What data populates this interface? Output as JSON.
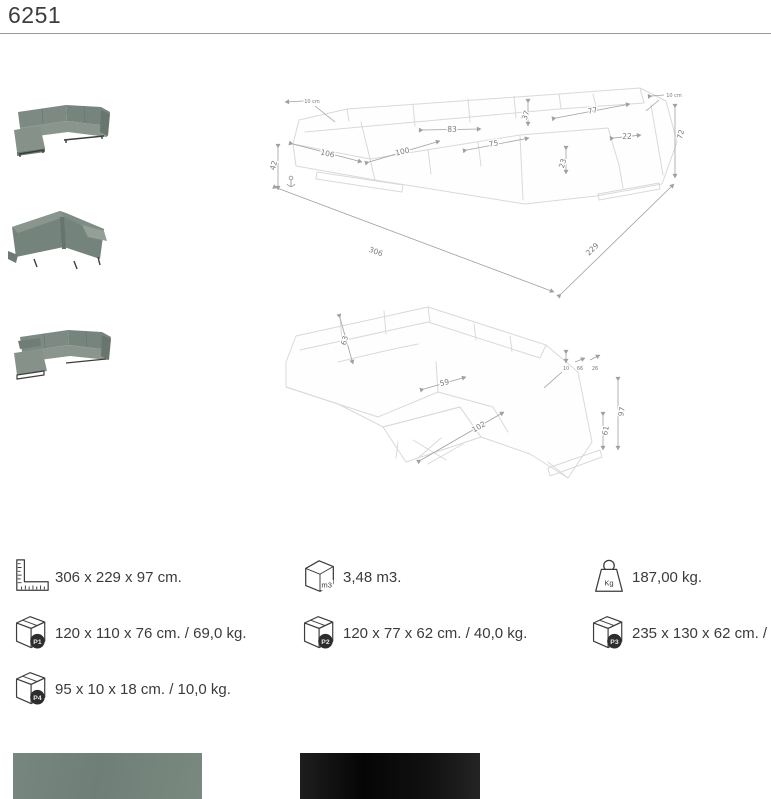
{
  "title": "6251",
  "colors": {
    "sofa_fabric": "#7b8a84",
    "swatch_green_grey": "#75847d",
    "swatch_black": "#121212",
    "line_art": "#d9d9d9",
    "dimension_grey": "#7a7a7a"
  },
  "drawing_top": {
    "dims": {
      "headrest_left": "10 cm",
      "corner_back_width": "83",
      "back_cushion_height": "37",
      "right_back_width": "77",
      "arm_width": "22",
      "height_total": "72",
      "headrest_right": "10 cm",
      "chaise_front": "106",
      "seat_front": "100",
      "right_seat_front": "75",
      "seat_front_height": "23",
      "seat_height": "42",
      "length_total": "306",
      "depth_total": "229"
    }
  },
  "drawing_bottom": {
    "dims": {
      "back_cushion": "63",
      "corner_seat": "59",
      "recline_depth": "102",
      "footrest_height": "61",
      "height_headrest_up": "97",
      "inset_a": "10",
      "inset_b": "66",
      "inset_c": "26"
    }
  },
  "specs": {
    "dimensions": {
      "icon": "ruler-square-icon",
      "text": "306 x 229 x 97 cm."
    },
    "volume": {
      "icon": "cube-m3-icon",
      "icon_label": "m3",
      "text": "3,48 m3."
    },
    "weight": {
      "icon": "weight-kg-icon",
      "icon_label": "Kg",
      "text": "187,00 kg."
    },
    "packages": [
      {
        "icon": "package-box-icon",
        "badge": "P1",
        "text": "120 x 110 x 76 cm. / 69,0 kg."
      },
      {
        "icon": "package-box-icon",
        "badge": "P2",
        "text": "120 x 77 x 62 cm. / 40,0 kg."
      },
      {
        "icon": "package-box-icon",
        "badge": "P3",
        "text": "235 x 130 x 62 cm. / 83,0 kg."
      },
      {
        "icon": "package-box-icon",
        "badge": "P4",
        "text": "95 x 10 x 18 cm. / 10,0 kg."
      }
    ]
  }
}
